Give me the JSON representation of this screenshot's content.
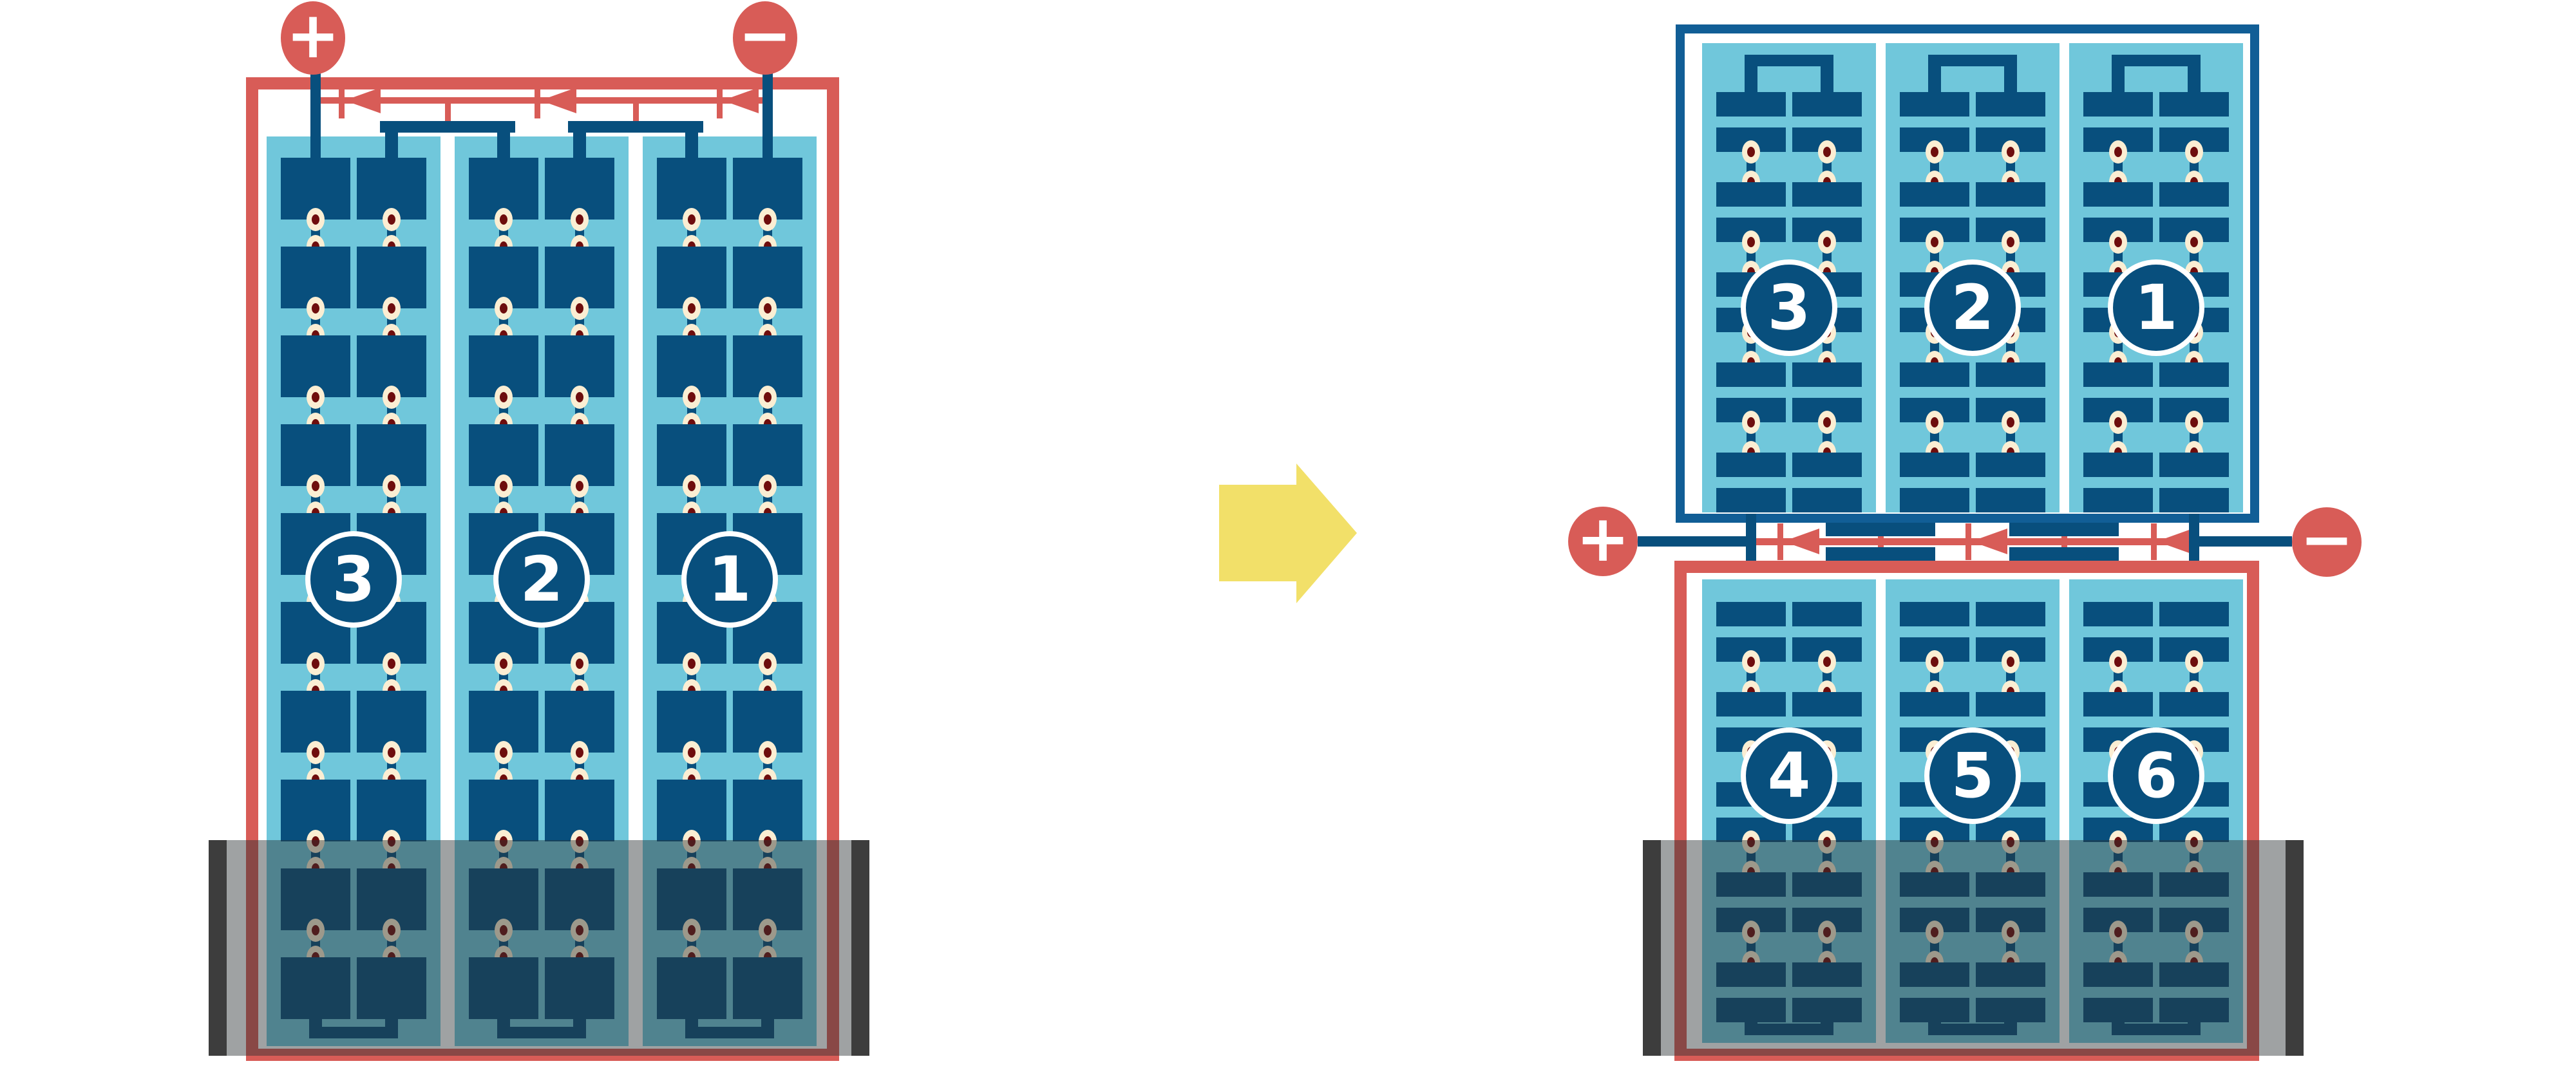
{
  "diagram_type": "solar-module cell string wiring comparison (full-cell module vs half-cut-cell module)",
  "colors": {
    "coral_red": "#d85c57",
    "cell_navy": "#084f7d",
    "frame_blue": "#115e96",
    "panel_light_blue": "#70c7db",
    "solder_pad_cream": "#fbeed3",
    "solder_dot_red": "#6e0d0d",
    "arrow_yellow": "#f2e069",
    "shade_end_bar": "#3d3d3d"
  },
  "left_diagram": {
    "terminals": {
      "positive": "+",
      "negative": "−"
    },
    "strings": {
      "circle_labels": [
        "3",
        "2",
        "1"
      ]
    },
    "structure": {
      "strings": 3,
      "columns_per_string": 2,
      "cell_rows": 10,
      "bypass_diodes": 3,
      "shaded_region": "bottom"
    }
  },
  "transition_arrow": {
    "direction": "right"
  },
  "right_diagram": {
    "terminals": {
      "positive": "+",
      "negative": "−"
    },
    "top_panel": {
      "circle_labels": [
        "3",
        "2",
        "1"
      ]
    },
    "bottom_panel": {
      "circle_labels": [
        "4",
        "5",
        "6"
      ]
    },
    "structure": {
      "strings_per_half": 3,
      "half_cell_groups_per_column": 5,
      "bypass_diodes": 3,
      "junction_location": "center",
      "shaded_region": "bottom"
    }
  }
}
